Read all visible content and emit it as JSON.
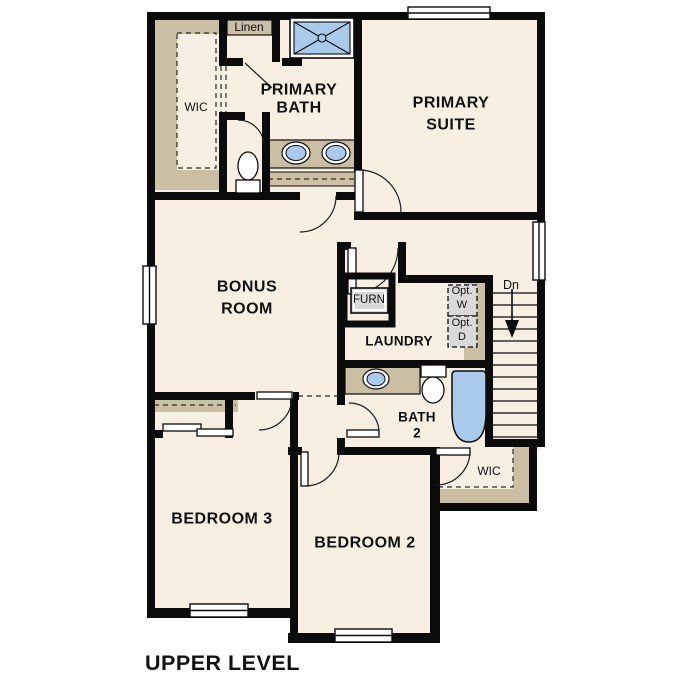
{
  "title": "UPPER LEVEL",
  "colors": {
    "wall": "#0b0b0b",
    "floor": "#f7efe2",
    "shelf_tan": "#cbbfa3",
    "fixture_blue": "#aacaeb",
    "fixture_gray": "#d9d9d9"
  },
  "rooms": {
    "primary_suite": {
      "label_line1": "PRIMARY",
      "label_line2": "SUITE"
    },
    "primary_bath": {
      "label_line1": "PRIMARY",
      "label_line2": "BATH"
    },
    "wic_primary": {
      "label": "WIC"
    },
    "linen": {
      "label": "Linen"
    },
    "bonus_room": {
      "label_line1": "BONUS",
      "label_line2": "ROOM"
    },
    "laundry": {
      "label": "LAUNDRY"
    },
    "furnace": {
      "label": "FURN"
    },
    "opt_washer": {
      "label_line1": "Opt.",
      "label_line2": "W"
    },
    "opt_dryer": {
      "label_line1": "Opt.",
      "label_line2": "D"
    },
    "stairs": {
      "label": "Dn"
    },
    "bath2": {
      "label_line1": "BATH",
      "label_line2": "2"
    },
    "bedroom2": {
      "label": "BEDROOM 2"
    },
    "bedroom3": {
      "label": "BEDROOM 3"
    },
    "wic_bedroom2": {
      "label": "WIC"
    }
  }
}
